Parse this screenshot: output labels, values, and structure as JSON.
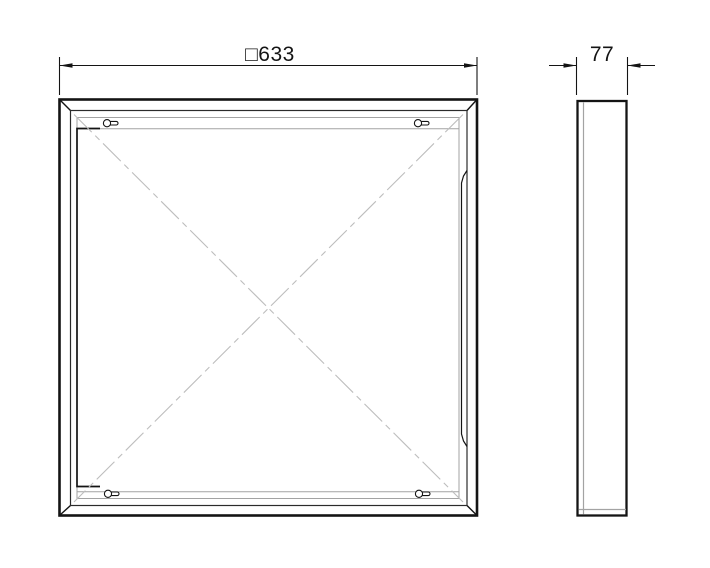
{
  "drawing": {
    "front_dimension_label": "□633",
    "front_dimension_value": 633,
    "side_dimension_label": "77",
    "side_dimension_value": 77,
    "views": [
      "front",
      "side"
    ],
    "mounting_keyhole_count": 4
  },
  "style": {
    "line_color": "#141414",
    "thin_line_color": "#9f9f9f",
    "centerline_color": "#bdbdbd",
    "background_color": "#ffffff"
  }
}
